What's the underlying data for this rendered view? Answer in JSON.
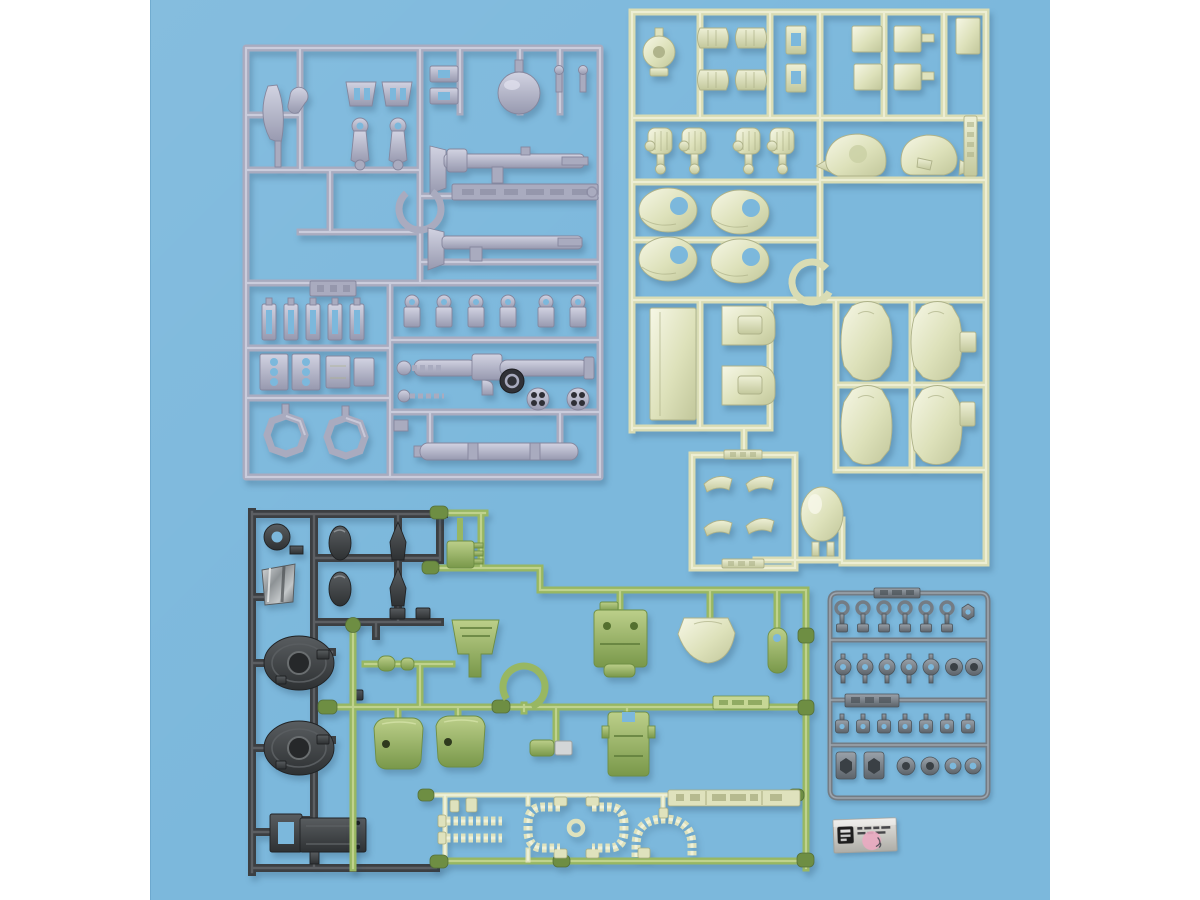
{
  "meta": {
    "title": "Photograph of plastic model kit runner sprues laid on a light blue backdrop",
    "media": "product-photo"
  },
  "colors": {
    "white": "#ffffff",
    "bg": "#7cb8dc",
    "bgLight": "#8ac0e1",
    "shadow": "rgba(30,62,90,0.25)",
    "gray": "#a9abbf",
    "grayHi": "#d0d1e0",
    "grayDk": "#85869d",
    "pale": "#d9dcb4",
    "paleHi": "#eef0d6",
    "paleDk": "#aeb289",
    "green": "#98b762",
    "greenHi": "#c6d795",
    "greenDk": "#6e8e43",
    "dark": "#3c3f42",
    "darkHi": "#64686b",
    "pc": "#747c84",
    "pcHi": "#a5adb5",
    "pcDk": "#4c5359",
    "hose": "#dfe2bd",
    "hoseHi": "#f3f5e0",
    "hoseDk": "#a8ac80",
    "silver": "#cecdc8",
    "ink": "#1e1e1e",
    "pink": "#eaaac1"
  },
  "backdrop": {
    "description": "seamless light blue paper backdrop with white table margins left and right",
    "margin_hex": "#ffffff",
    "paper_hex": "#7cb8dc"
  },
  "runners": [
    {
      "id": "gray",
      "label": "gray weapon and detail runner",
      "hex": "#a9abbf",
      "position": "top-left",
      "notable": [
        "axe blade",
        "hook",
        "arm joints",
        "sphere",
        "two long rifles",
        "bazooka with grip",
        "long tube",
        "two ring frames",
        "manifold blocks",
        "row of ring mounts",
        "embossed tag (illegible)"
      ]
    },
    {
      "id": "pale-green",
      "label": "pale sage outer-armor runner",
      "hex": "#d9dcb4",
      "position": "top-right",
      "notable": [
        "round turret",
        "wrist guards",
        "four fists",
        "two spiked head halves",
        "four oval feet",
        "tall rectangular plate",
        "two boots",
        "four curved leg shells",
        "open ring",
        "dome piece",
        "small curved parts sub-frame",
        "embossed tags (illegible)"
      ]
    },
    {
      "id": "dark-gray",
      "label": "dark gunmetal frame runner",
      "hex": "#3c3f42",
      "position": "bottom-left",
      "notable": [
        "donut ring",
        "shiny metallic bucket",
        "two oval covers",
        "two spearheads",
        "two round shoulder shields with center rings",
        "flat base plate"
      ]
    },
    {
      "id": "green",
      "label": "zaku-green body runner",
      "hex": "#98b762",
      "position": "bottom-center",
      "notable": [
        "finned power box",
        "chest vent",
        "backpack block",
        "pale skirt shell",
        "waist block",
        "open ring",
        "two curved leg shells",
        "silver-tipped arm piece",
        "beaded power-pipe parts",
        "two embossed tag bars (illegible)"
      ]
    },
    {
      "id": "polycap",
      "label": "small gray polycap joint runner",
      "hex": "#747c84",
      "position": "mid-right",
      "rows": 4,
      "notable": [
        "rows of small joint caps",
        "hex sockets",
        "two embossed tags (illegible)"
      ]
    }
  ],
  "sticker": {
    "label": "factory inspection foil sticker",
    "base_hex": "#cecdc8",
    "logo_hex": "#1e1e1e",
    "stamp": "pink circular stamp with pen mark",
    "stamp_hex": "#eaaac1",
    "text_legible": false
  }
}
